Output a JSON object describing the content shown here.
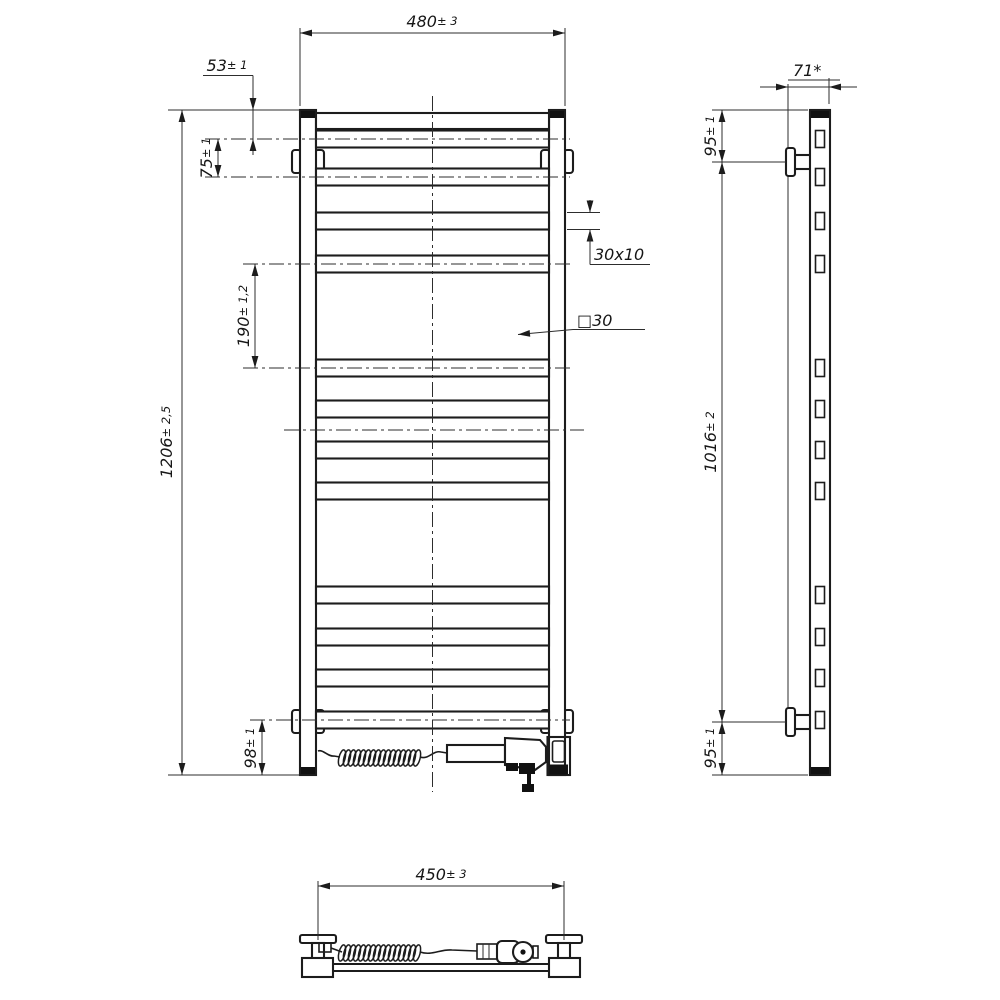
{
  "drawing": {
    "front_view": {
      "width": {
        "value": "480",
        "tolerance": "± 3"
      },
      "height": {
        "value": "1206",
        "tolerance": "± 2,5"
      },
      "top_rung_offset": {
        "value": "53",
        "tolerance": "± 1"
      },
      "rung_pitch": {
        "value": "75",
        "tolerance": "± 1"
      },
      "rung_group_gap": {
        "value": "190",
        "tolerance": "± 1,2"
      },
      "bottom_rung_offset": {
        "value": "98",
        "tolerance": "± 1"
      },
      "rung_profile": "30x10",
      "post_profile": "□30"
    },
    "side_view": {
      "depth": "71*",
      "top_bracket_offset": {
        "value": "95",
        "tolerance": "± 1"
      },
      "bracket_span": {
        "value": "1016",
        "tolerance": "± 2"
      },
      "bottom_bracket_offset": {
        "value": "95",
        "tolerance": "± 1"
      }
    },
    "bottom_view": {
      "bracket_spacing": {
        "value": "450",
        "tolerance": "± 3"
      }
    }
  }
}
